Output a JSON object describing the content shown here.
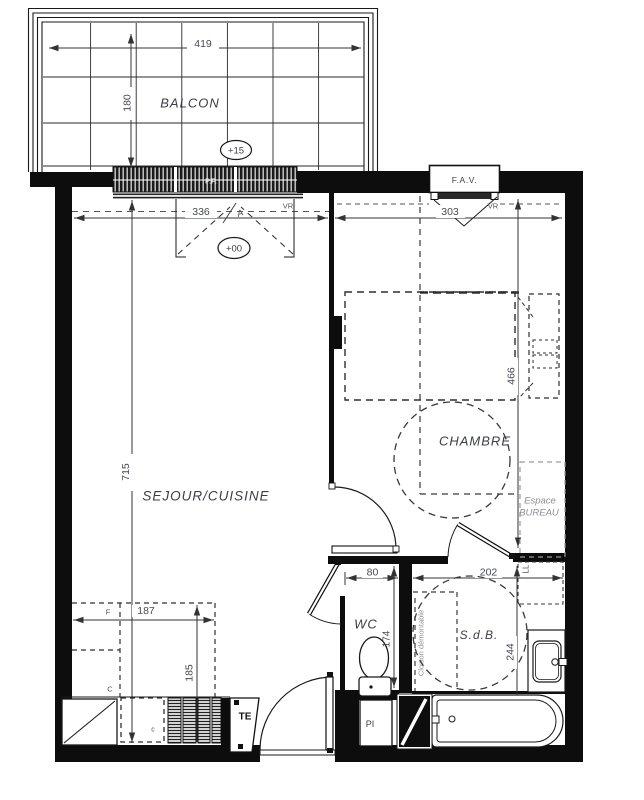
{
  "plan": {
    "title": "apartment-floor-plan",
    "rooms": {
      "balcony": "BALCON",
      "living": "SEJOUR/CUISINE",
      "bedroom": "CHAMBRE",
      "wc": "WC",
      "bath": "S.d.B.",
      "office_line1": "Espace",
      "office_line2": "BUREAU"
    },
    "levels": {
      "balcony": "+15",
      "living": "+00"
    },
    "dims": {
      "balcony_width": "419",
      "balcony_depth": "180",
      "living_width": "336",
      "bedroom_width": "303",
      "living_depth": "715",
      "bedroom_depth": "466",
      "wc_width": "80",
      "bath_width": "202",
      "kitchen_width": "187",
      "kitchen_depth": "185",
      "wc_depth": "174",
      "bath_depth": "244"
    },
    "tags": {
      "fav": "F.A.V.",
      "pf": "P.F.",
      "vr_living": "VR",
      "vr_bedroom": "VR",
      "te": "TE",
      "pi": "PI",
      "ll": "LL",
      "fridge": "F",
      "closet": "C",
      "oven_mark": "c",
      "section_mark": "A",
      "partition": "Cloison démontable"
    },
    "colors": {
      "wall": "#0d0d0d",
      "line": "#1a1a1a",
      "dim_text": "#474a52",
      "gray_label": "#8d8f96"
    }
  }
}
